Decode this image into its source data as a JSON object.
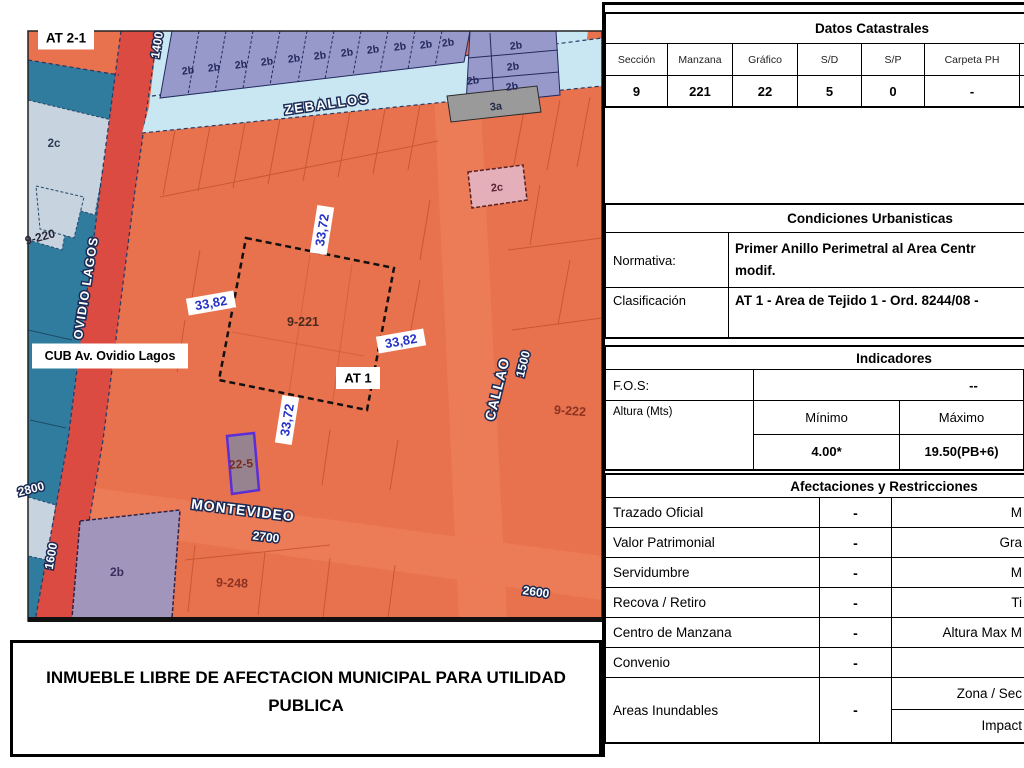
{
  "statement": {
    "line1": "INMUEBLE LIBRE DE AFECTACION MUNICIPAL PARA UTILIDAD",
    "line2": "PUBLICA"
  },
  "datos_catastrales": {
    "title": "Datos Catastrales",
    "columns": [
      {
        "header": "Sección",
        "value": "9"
      },
      {
        "header": "Manzana",
        "value": "221"
      },
      {
        "header": "Gráfico",
        "value": "22"
      },
      {
        "header": "S/D",
        "value": "5"
      },
      {
        "header": "S/P",
        "value": "0"
      },
      {
        "header": "Carpeta PH",
        "value": "-"
      }
    ]
  },
  "condiciones": {
    "title": "Condiciones Urbanisticas",
    "rows": [
      {
        "label": "Normativa:",
        "value_lines": [
          "Primer Anillo Perimetral al Area Centr",
          "modif."
        ]
      },
      {
        "label": "Clasificación",
        "value_lines": [
          "AT 1 - Area de Tejido 1 - Ord. 8244/08 -"
        ]
      }
    ]
  },
  "indicadores": {
    "title": "Indicadores",
    "fos_label": "F.O.S:",
    "fos_value": "--",
    "altura_label": "Altura (Mts)",
    "min_header": "Mínimo",
    "max_header": "Máximo",
    "min_value": "4.00*",
    "max_value": "19.50(PB+6)"
  },
  "afectaciones": {
    "title": "Afectaciones y Restricciones",
    "rows": [
      {
        "label": "Trazado Oficial",
        "dash": "-",
        "right": "M"
      },
      {
        "label": "Valor Patrimonial",
        "dash": "-",
        "right": "Gra"
      },
      {
        "label": "Servidumbre",
        "dash": "-",
        "right": "M"
      },
      {
        "label": "Recova / Retiro",
        "dash": "-",
        "right": "Ti"
      },
      {
        "label": "Centro de Manzana",
        "dash": "-",
        "right": "Altura Max M"
      },
      {
        "label": "Convenio",
        "dash": "-",
        "right": ""
      }
    ],
    "areas_row": {
      "label": "Areas Inundables",
      "dash": "-",
      "right_top": "Zona / Sec",
      "right_bottom": "Impact"
    }
  },
  "map": {
    "colors": {
      "orange_zone": "#E8724E",
      "street_lighter": "#EC7B57",
      "red_avenue": "#DC4B42",
      "teal_zone": "#2F7C9F",
      "light_parcel": "#C7D3DE",
      "zeballos_blue": "#C8E7F2",
      "lavender_2b": "#9799CA",
      "purple_2b": "#A295BC",
      "pink_2c": "#E5AFBA",
      "gray_3a": "#9A9A9A",
      "subject_fill": "#97838F",
      "subject_stroke": "#5B2ED6",
      "dim_blue": "#2633C8",
      "parcel_red": "#8C3222"
    },
    "labels": [
      {
        "n": "street-label-zeballos",
        "t": "ZEBALLOS",
        "x": 327,
        "y": 104,
        "r": -8,
        "k": "street",
        "s": 13,
        "ls": 2
      },
      {
        "n": "street-label-ovidio-lagos",
        "t": "OVIDIO LAGOS",
        "x": 86,
        "y": 288,
        "r": -81,
        "k": "street",
        "s": 12.5,
        "ls": 1
      },
      {
        "n": "street-label-callao",
        "t": "CALLAO",
        "x": 497,
        "y": 389,
        "r": -76,
        "k": "street",
        "s": 14,
        "ls": 1
      },
      {
        "n": "street-label-montevideo",
        "t": "MONTEVIDEO",
        "x": 243,
        "y": 510,
        "r": 7,
        "k": "street",
        "s": 14,
        "ls": 1
      },
      {
        "n": "block-number-1400",
        "t": "1400",
        "x": 157,
        "y": 45,
        "r": -81,
        "k": "num",
        "s": 12
      },
      {
        "n": "block-number-1500",
        "t": "1500",
        "x": 523,
        "y": 364,
        "r": -76,
        "k": "num",
        "s": 12
      },
      {
        "n": "block-number-1600",
        "t": "1600",
        "x": 51,
        "y": 556,
        "r": -80,
        "k": "num",
        "s": 12
      },
      {
        "n": "block-number-2600",
        "t": "2600",
        "x": 536,
        "y": 592,
        "r": 8,
        "k": "num",
        "s": 12
      },
      {
        "n": "block-number-2700",
        "t": "2700",
        "x": 266,
        "y": 537,
        "r": 7,
        "k": "num",
        "s": 12
      },
      {
        "n": "block-number-2800",
        "t": "2800",
        "x": 31,
        "y": 489,
        "r": -14,
        "k": "num",
        "s": 12
      },
      {
        "n": "parcel-label-9-220",
        "t": "9-220",
        "x": 40,
        "y": 237,
        "r": -15,
        "k": "parcel",
        "s": 12,
        "c": "#2A2438"
      },
      {
        "n": "parcel-label-9-221",
        "t": "9-221",
        "x": 303,
        "y": 322,
        "r": 0,
        "k": "parcel",
        "s": 12.5,
        "c": "#4A2A1C"
      },
      {
        "n": "parcel-label-9-222",
        "t": "9-222",
        "x": 570,
        "y": 411,
        "r": 4,
        "k": "parcel",
        "s": 12.5,
        "c": "#8C3222"
      },
      {
        "n": "parcel-label-9-248",
        "t": "9-248",
        "x": 232,
        "y": 583,
        "r": 2,
        "k": "parcel",
        "s": 12.5,
        "c": "#8C3222"
      },
      {
        "n": "parcel-label-22-5",
        "t": "22-5",
        "x": 241,
        "y": 464,
        "r": -4,
        "k": "parcel",
        "s": 12,
        "c": "#7B2A1E"
      },
      {
        "n": "zone-label-2c-left",
        "t": "2c",
        "x": 54,
        "y": 144,
        "r": 0,
        "k": "parcel",
        "s": 11.5,
        "c": "#2A3A55"
      },
      {
        "n": "zone-label-2c-pink",
        "t": "2c",
        "x": 497,
        "y": 188,
        "r": -6,
        "k": "parcel",
        "s": 11,
        "c": "#5A2430"
      },
      {
        "n": "zone-label-3a",
        "t": "3a",
        "x": 496,
        "y": 107,
        "r": -6,
        "k": "parcel",
        "s": 11,
        "c": "#1E2A44"
      },
      {
        "n": "zone-label-2b-1",
        "t": "2b",
        "x": 188,
        "y": 71,
        "r": -7,
        "k": "parcel",
        "s": 10.5,
        "c": "#23295E"
      },
      {
        "n": "zone-label-2b-2",
        "t": "2b",
        "x": 214,
        "y": 68,
        "r": -7,
        "k": "parcel",
        "s": 10.5,
        "c": "#23295E"
      },
      {
        "n": "zone-label-2b-3",
        "t": "2b",
        "x": 241,
        "y": 65,
        "r": -7,
        "k": "parcel",
        "s": 10.5,
        "c": "#23295E"
      },
      {
        "n": "zone-label-2b-4",
        "t": "2b",
        "x": 267,
        "y": 62,
        "r": -7,
        "k": "parcel",
        "s": 10.5,
        "c": "#23295E"
      },
      {
        "n": "zone-label-2b-5",
        "t": "2b",
        "x": 294,
        "y": 59,
        "r": -7,
        "k": "parcel",
        "s": 10.5,
        "c": "#23295E"
      },
      {
        "n": "zone-label-2b-6",
        "t": "2b",
        "x": 320,
        "y": 56,
        "r": -7,
        "k": "parcel",
        "s": 10.5,
        "c": "#23295E"
      },
      {
        "n": "zone-label-2b-7",
        "t": "2b",
        "x": 347,
        "y": 53,
        "r": -7,
        "k": "parcel",
        "s": 10.5,
        "c": "#23295E"
      },
      {
        "n": "zone-label-2b-8",
        "t": "2b",
        "x": 373,
        "y": 50,
        "r": -7,
        "k": "parcel",
        "s": 10.5,
        "c": "#23295E"
      },
      {
        "n": "zone-label-2b-9",
        "t": "2b",
        "x": 400,
        "y": 47,
        "r": -7,
        "k": "parcel",
        "s": 10.5,
        "c": "#23295E"
      },
      {
        "n": "zone-label-2b-10",
        "t": "2b",
        "x": 426,
        "y": 45,
        "r": -7,
        "k": "parcel",
        "s": 10.5,
        "c": "#23295E"
      },
      {
        "n": "zone-label-2b-11",
        "t": "2b",
        "x": 448,
        "y": 43,
        "r": -7,
        "k": "parcel",
        "s": 10.5,
        "c": "#23295E"
      },
      {
        "n": "zone-label-2b-stack1",
        "t": "2b",
        "x": 516,
        "y": 46,
        "r": -7,
        "k": "parcel",
        "s": 10.5,
        "c": "#23295E"
      },
      {
        "n": "zone-label-2b-stack2",
        "t": "2b",
        "x": 513,
        "y": 67,
        "r": -7,
        "k": "parcel",
        "s": 10.5,
        "c": "#23295E"
      },
      {
        "n": "zone-label-2b-stack3",
        "t": "2b",
        "x": 512,
        "y": 87,
        "r": -7,
        "k": "parcel",
        "s": 10.5,
        "c": "#23295E"
      },
      {
        "n": "zone-label-2b-stackleft",
        "t": "2b",
        "x": 473,
        "y": 81,
        "r": -7,
        "k": "parcel",
        "s": 10.5,
        "c": "#23295E"
      },
      {
        "n": "zone-label-2b-purple",
        "t": "2b",
        "x": 117,
        "y": 572,
        "r": 0,
        "k": "parcel",
        "s": 12,
        "c": "#3A2E5E"
      },
      {
        "n": "dim-label-top",
        "t": "33,72",
        "x": 322,
        "y": 230,
        "r": -81,
        "k": "dim",
        "s": 13,
        "bw": 48,
        "bh": 17
      },
      {
        "n": "dim-label-left",
        "t": "33,82",
        "x": 211,
        "y": 303,
        "r": -10,
        "k": "dim",
        "s": 13,
        "bw": 48,
        "bh": 17
      },
      {
        "n": "dim-label-right",
        "t": "33,82",
        "x": 401,
        "y": 341,
        "r": -10,
        "k": "dim",
        "s": 13,
        "bw": 48,
        "bh": 17
      },
      {
        "n": "dim-label-bottom",
        "t": "33,72",
        "x": 287,
        "y": 420,
        "r": -81,
        "k": "dim",
        "s": 13,
        "bw": 48,
        "bh": 17
      },
      {
        "n": "zone-badge-at-2-1",
        "t": "AT 2-1",
        "x": 66,
        "y": 38,
        "r": 0,
        "k": "badge",
        "s": 13.5,
        "bw": 56,
        "bh": 23
      },
      {
        "n": "zone-badge-at-1",
        "t": "AT 1",
        "x": 358,
        "y": 378,
        "r": 0,
        "k": "badge",
        "s": 13,
        "bw": 44,
        "bh": 22
      },
      {
        "n": "cub-annotation",
        "t": "CUB Av. Ovidio Lagos",
        "x": 110,
        "y": 356,
        "r": 0,
        "k": "badge",
        "s": 12.5,
        "bw": 156,
        "bh": 25
      }
    ]
  }
}
